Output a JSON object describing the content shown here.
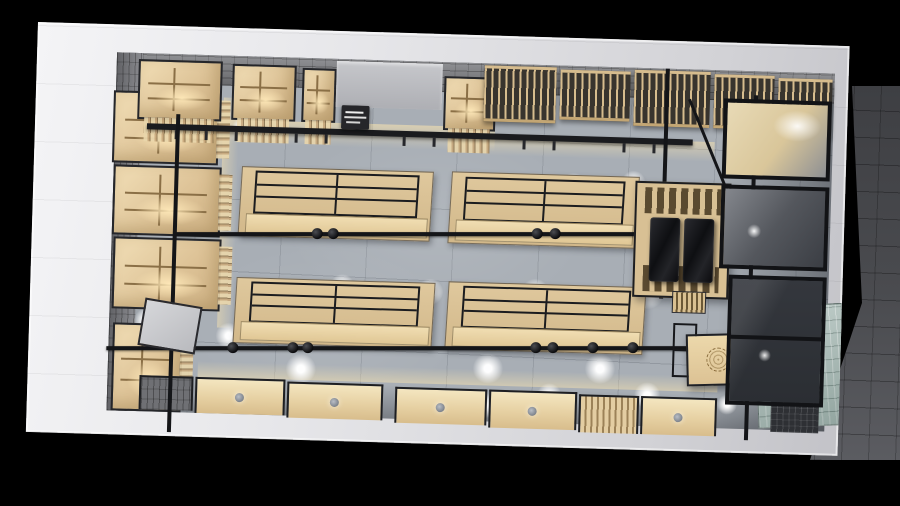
{
  "scene": {
    "description": "Top-down 3D architectural render of a retail clothing store: white perimeter walls on black background, gray tile floor, wooden wall cabinets with warm interior lighting, black metal track frames, four center gondola display tables with black clothing rails, timber-lattice feature wall along the top-right, black display island, wooden cash counter with circular motifs, teal mosaic entrance floor, glass storefront and dark exterior paving on the right",
    "hanging_sign": {
      "text": "",
      "legible": false
    }
  },
  "palette": {
    "background": "#000000",
    "outer-wall": "#e9e9ec",
    "floor": "#a8aeb5",
    "brick-wall": "#7d7e82",
    "wood": "#dfc69c",
    "wood-lit": "#f6e7c2",
    "metal": "#141518",
    "warm-glow": "#ffe9bf",
    "spotlight": "#ffffff",
    "mosaic-entry": "#afc1bc",
    "glass": "#34373d",
    "paving": "#47484c"
  },
  "fixtures": {
    "gondola_tables": [
      {
        "x": 207,
        "y": 138,
        "w": 190,
        "h": 68
      },
      {
        "x": 417,
        "y": 137,
        "w": 186,
        "h": 70
      },
      {
        "x": 205,
        "y": 249,
        "w": 197,
        "h": 64
      },
      {
        "x": 417,
        "y": 247,
        "w": 196,
        "h": 66
      }
    ],
    "left_wall_bays": [
      {
        "x": 78,
        "y": 66,
        "w": 106,
        "h": 72
      },
      {
        "x": 80,
        "y": 140,
        "w": 108,
        "h": 70
      },
      {
        "x": 82,
        "y": 212,
        "w": 108,
        "h": 72
      },
      {
        "x": 84,
        "y": 298,
        "w": 70,
        "h": 88
      }
    ],
    "top_wall_bays": [
      {
        "x": 102,
        "y": 34,
        "w": 84,
        "h": 60
      },
      {
        "x": 196,
        "y": 36,
        "w": 64,
        "h": 56
      },
      {
        "x": 266,
        "y": 38,
        "w": 34,
        "h": 54
      },
      {
        "x": 408,
        "y": 42,
        "w": 52,
        "h": 54
      }
    ],
    "lattice_panels": [
      {
        "x": 448,
        "y": 30,
        "w": 72,
        "h": 56
      },
      {
        "x": 524,
        "y": 32,
        "w": 70,
        "h": 50
      },
      {
        "x": 598,
        "y": 30,
        "w": 76,
        "h": 56
      },
      {
        "x": 678,
        "y": 32,
        "w": 60,
        "h": 54
      },
      {
        "x": 742,
        "y": 34,
        "w": 54,
        "h": 58
      }
    ],
    "bottom_wall_units": [
      {
        "x": 112,
        "y": 350,
        "w": 54,
        "h": 34,
        "type": "brick"
      },
      {
        "x": 168,
        "y": 350,
        "w": 90,
        "h": 36,
        "type": "wood"
      },
      {
        "x": 260,
        "y": 352,
        "w": 96,
        "h": 36,
        "type": "wood"
      },
      {
        "x": 368,
        "y": 354,
        "w": 92,
        "h": 36,
        "type": "wood"
      },
      {
        "x": 462,
        "y": 354,
        "w": 88,
        "h": 38,
        "type": "wood"
      },
      {
        "x": 552,
        "y": 356,
        "w": 60,
        "h": 38,
        "type": "slats"
      },
      {
        "x": 614,
        "y": 356,
        "w": 76,
        "h": 38,
        "type": "wood"
      }
    ],
    "light_pools": [
      [
        224,
        266,
        30
      ],
      [
        273,
        339,
        30
      ],
      [
        329,
        262,
        28
      ],
      [
        400,
        258,
        26
      ],
      [
        460,
        333,
        30
      ],
      [
        505,
        256,
        28
      ],
      [
        572,
        330,
        30
      ],
      [
        617,
        252,
        34
      ],
      [
        662,
        250,
        30
      ],
      [
        674,
        330,
        28
      ],
      [
        457,
        370,
        26
      ],
      [
        522,
        358,
        24
      ],
      [
        620,
        355,
        26
      ],
      [
        117,
        295,
        24
      ],
      [
        132,
        333,
        24
      ],
      [
        200,
        308,
        26
      ],
      [
        312,
        255,
        24
      ],
      [
        340,
        269,
        22
      ],
      [
        470,
        150,
        24
      ],
      [
        540,
        148,
        26
      ],
      [
        600,
        143,
        24
      ],
      [
        172,
        106,
        20
      ],
      [
        207,
        100,
        20
      ],
      [
        686,
        160,
        20
      ],
      [
        700,
        362,
        20
      ]
    ],
    "track_a_dots": [
      138,
      154,
      358,
      376
    ],
    "track_b_dots": [
      121,
      181,
      196,
      424,
      441,
      481,
      521,
      659
    ],
    "beam_ticks": [
      28,
      58,
      88,
      148,
      178,
      256,
      286,
      376,
      406,
      476,
      506
    ]
  }
}
